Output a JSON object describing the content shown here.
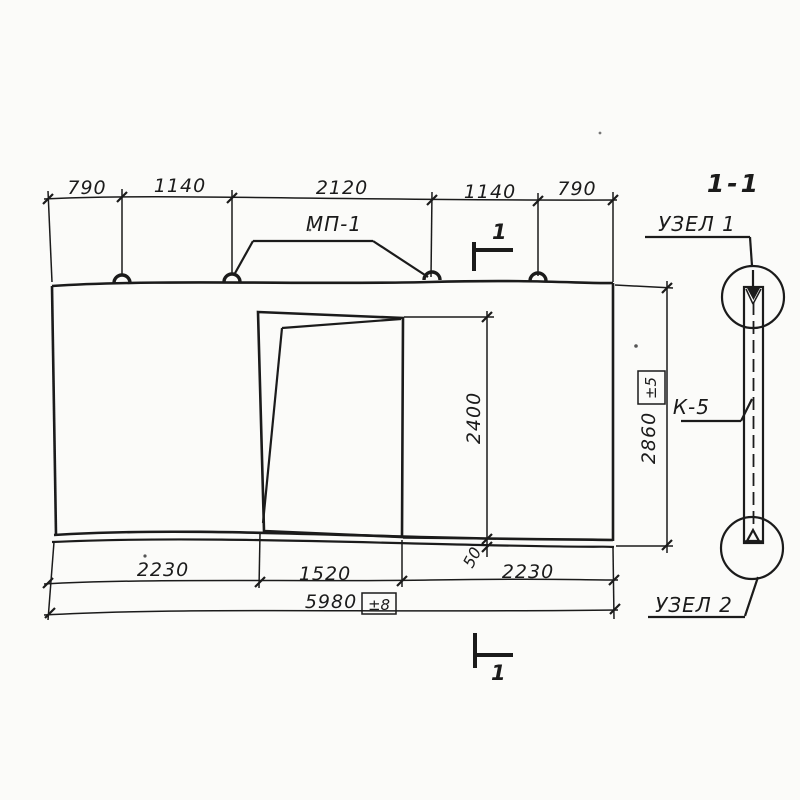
{
  "colors": {
    "paper": "#fbfbf9",
    "ink": "#1b1b1b"
  },
  "elevation_view": {
    "top_dimensions": [
      "790",
      "1140",
      "2120",
      "1140",
      "790"
    ],
    "lifting_loop_label": "МП-1",
    "section_cut_number_top": "1",
    "section_cut_number_bottom": "1",
    "opening_height": "2400",
    "opening_to_bottom_gap": "50",
    "panel_height": "2860",
    "panel_height_tolerance": "±5",
    "bottom_dimensions": [
      "2230",
      "1520",
      "2230"
    ],
    "overall_width": "5980",
    "overall_width_tolerance": "±8"
  },
  "section_view": {
    "title": "1-1",
    "detail_1_label": "УЗЕЛ 1",
    "detail_2_label": "УЗЕЛ 2",
    "connector_label": "К-5"
  }
}
